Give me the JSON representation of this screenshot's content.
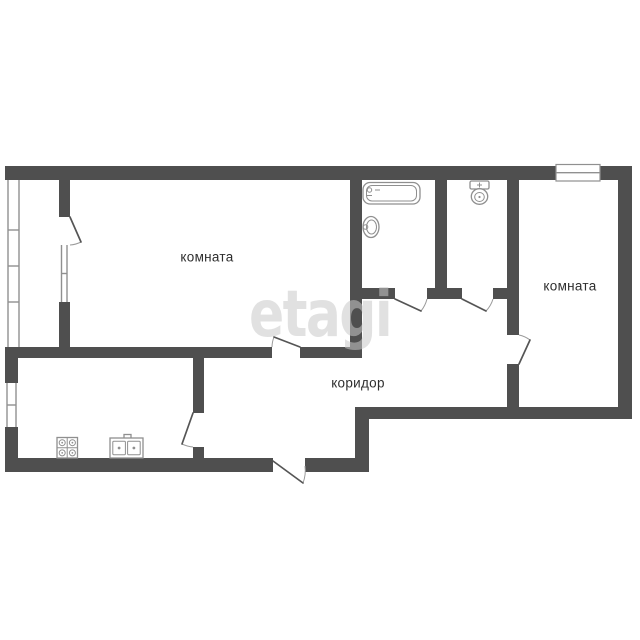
{
  "plan": {
    "type": "apartment-floor-plan",
    "rooms": [
      {
        "id": "room-1",
        "label": "комната"
      },
      {
        "id": "room-2",
        "label": "комната"
      },
      {
        "id": "corridor",
        "label": "коридор"
      }
    ],
    "watermark": "etagi",
    "fixtures": [
      "bathtub",
      "wash-basin",
      "toilet",
      "stove",
      "kitchen-sink"
    ],
    "features": [
      "balcony-glazing-left",
      "balcony-door",
      "balcony-window",
      "kitchen-window",
      "top-right-window",
      "entrance-door",
      "kitchen-door",
      "room-1-door",
      "room-2-door",
      "bathroom-door",
      "toilet-door"
    ]
  },
  "colors": {
    "background": "#ffffff",
    "wall": "#4f4f4f",
    "window-stroke": "#909090",
    "door-stroke": "#555555",
    "arc-stroke": "#9a9a9a",
    "fixture-stroke": "#8f8f8f",
    "label": "#2e2e2e",
    "watermark": "rgba(200,200,200,0.55)"
  }
}
